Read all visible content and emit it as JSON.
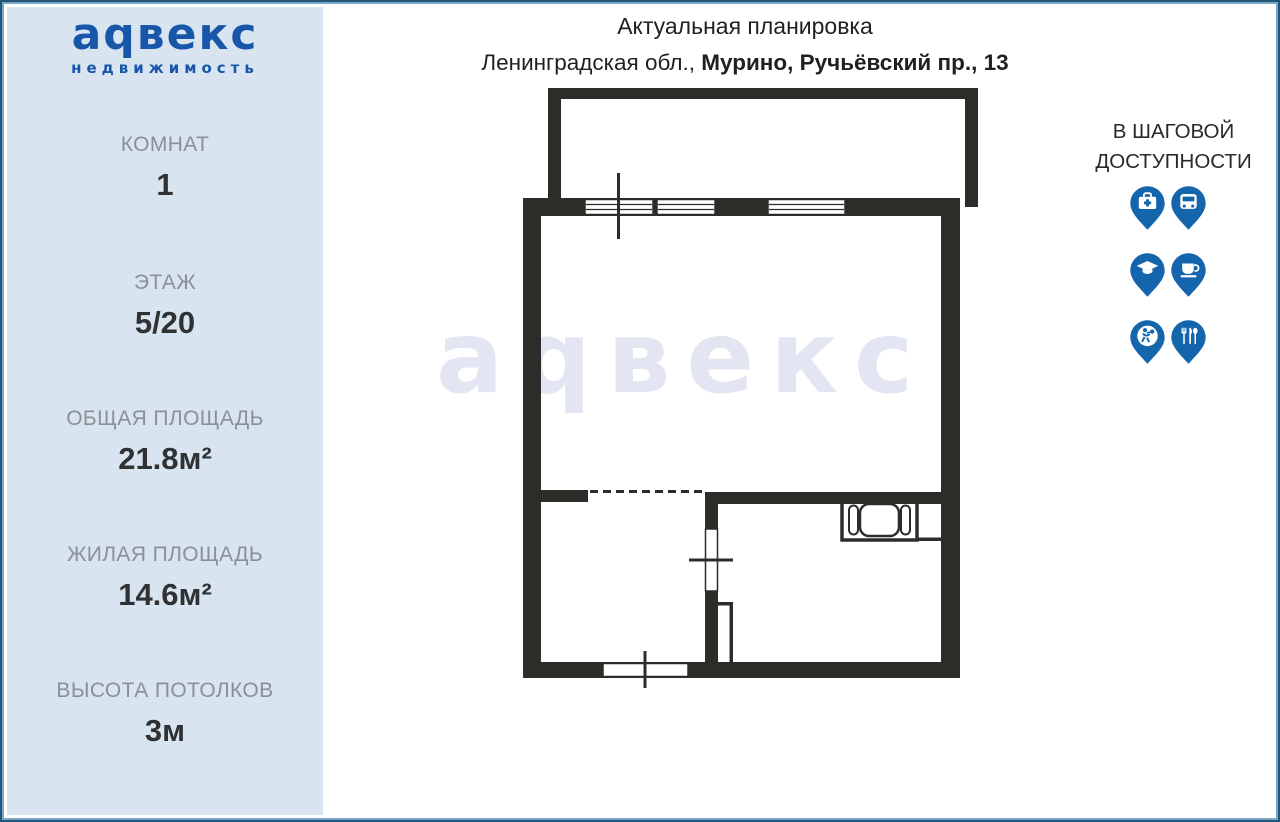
{
  "colors": {
    "brand_blue": "#1856a9",
    "pin_blue": "#1565ad",
    "wall_black": "#2e2c29",
    "sidebar_bg": "#d8e4f0",
    "watermark": "#e3e6f2",
    "frame_dark": "#235679",
    "frame_mid": "#78a7c8"
  },
  "sidebar": {
    "logo": {
      "text": "аqвекс",
      "subtext": "недвижимость"
    },
    "stats": [
      {
        "label": "КОМНАТ",
        "value": "1"
      },
      {
        "label": "ЭТАЖ",
        "value": "5/20"
      },
      {
        "label": "ОБЩАЯ ПЛОЩАДЬ",
        "value": "21.8м²"
      },
      {
        "label": "ЖИЛАЯ ПЛОЩАДЬ",
        "value": "14.6м²"
      },
      {
        "label": "ВЫСОТА ПОТОЛКОВ",
        "value": "3м"
      }
    ]
  },
  "header": {
    "title": "Актуальная планировка",
    "address_prefix": "Ленинградская обл., ",
    "address_bold": "Мурино, Ручьёвский пр., 13"
  },
  "watermark": "аqвекс",
  "nearby": {
    "title_line1": "В ШАГОВОЙ",
    "title_line2": "ДОСТУПНОСТИ",
    "icons": [
      {
        "name": "medical-pin-icon"
      },
      {
        "name": "bus-pin-icon"
      },
      {
        "name": "education-pin-icon"
      },
      {
        "name": "cafe-pin-icon"
      },
      {
        "name": "sports-pin-icon"
      },
      {
        "name": "restaurant-pin-icon"
      }
    ]
  }
}
